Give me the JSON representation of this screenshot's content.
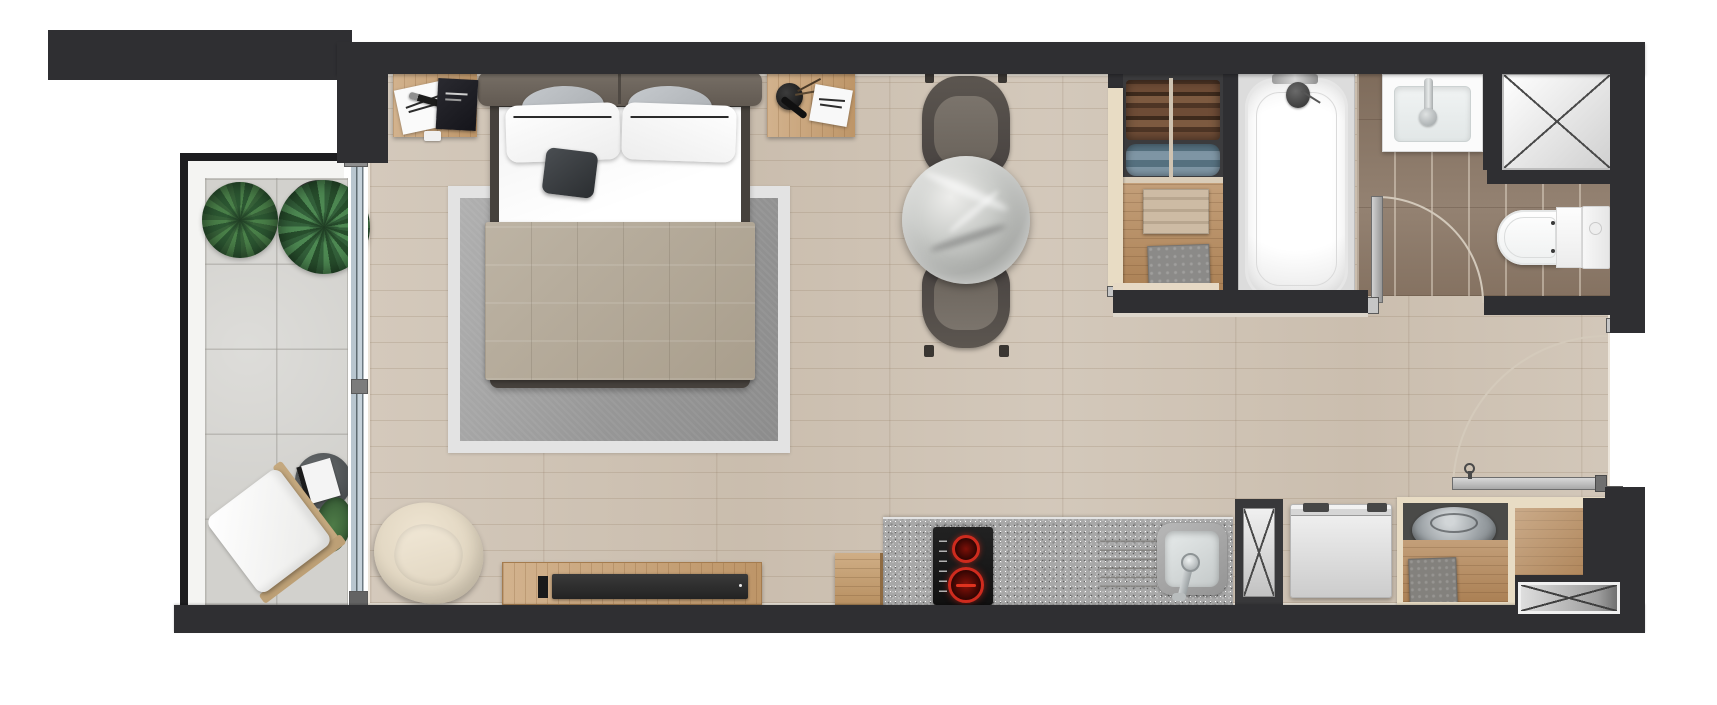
{
  "meta": {
    "type": "architectural-floor-plan",
    "view": "top-down-render",
    "canvas": {
      "width": 1717,
      "height": 705
    },
    "title": "Studio apartment floor plan"
  },
  "colors": {
    "wall": "#2f2f32",
    "wall-edge-light": "#ece5da",
    "wood-floor": "#cfc3b4",
    "bath-tile": "#8d7a69",
    "balcony-tile": "#d2d1cd",
    "granite": "#a8a8a8",
    "glass": "#b9c6cf",
    "partition-beige": "#e8dcc4",
    "closet-wood": "#b68a5c",
    "rug-inner": "#9d9d9d",
    "rug-border": "#e3e3e3",
    "blanket": "#b2a795",
    "headboard": "#6e665d",
    "bedframe": "#46413c",
    "dining-chair": "#554f4a",
    "marble": "#c3c5c2",
    "armchair": "#e5dbc7",
    "console-wood": "#c79f71",
    "burner-red": "#cf2b1e",
    "plant-green": "#3a6b3e",
    "door-arc": "#d2c8ba",
    "tub-white": "#ffffff"
  },
  "rooms": {
    "balcony": {
      "name": "balcony",
      "floor": "concrete-tiles",
      "items": [
        "plant-pot",
        "plant-pot",
        "round-side-table",
        "flower-bouquet",
        "book",
        "lounge-chair",
        "sliding-glass-door"
      ]
    },
    "living": {
      "name": "living-bedroom-studio",
      "floor": "light-oak-planks",
      "items": [
        "double-bed",
        "headboard",
        "gray-pillow",
        "gray-pillow",
        "white-pillow",
        "white-pillow",
        "dark-cushion",
        "bed-blanket",
        "area-rug",
        "nightstand",
        "nightstand",
        "magazine",
        "pen",
        "book",
        "vase",
        "armchair",
        "tv-console",
        "tv-soundbar",
        "marble-dining-table",
        "dining-chair",
        "dining-chair"
      ]
    },
    "wardrobe": {
      "name": "wardrobe-closet",
      "floor": "wood-shelf",
      "items": [
        "hanging-clothes-rail",
        "folded-towels-beige",
        "folded-towel-gray"
      ]
    },
    "bathroom": {
      "name": "bathroom",
      "floor": "dark-wood-tiles",
      "items": [
        "bathtub",
        "tub-faucet",
        "washbasin",
        "basin-faucet",
        "toilet",
        "door-swing",
        "duct-shaft-x"
      ]
    },
    "kitchen": {
      "name": "kitchenette",
      "floor": "light-oak-planks",
      "items": [
        "granite-counter",
        "induction-hob",
        "hob-burner",
        "hob-burner",
        "kitchen-sink",
        "sink-faucet",
        "drainer-grooves",
        "wood-stool"
      ]
    },
    "entry": {
      "name": "entry-hall",
      "floor": "light-oak-planks",
      "items": [
        "entry-door-swing",
        "washing-machine",
        "duct-shaft-x",
        "storage-cabinet",
        "laundry-basket",
        "folded-towel-gray",
        "wood-shelf",
        "duct-shaft-x-small"
      ]
    }
  },
  "symbols": {
    "x-shaft-count": 3,
    "door-swing-count": 2,
    "sliding-door-count": 1
  }
}
